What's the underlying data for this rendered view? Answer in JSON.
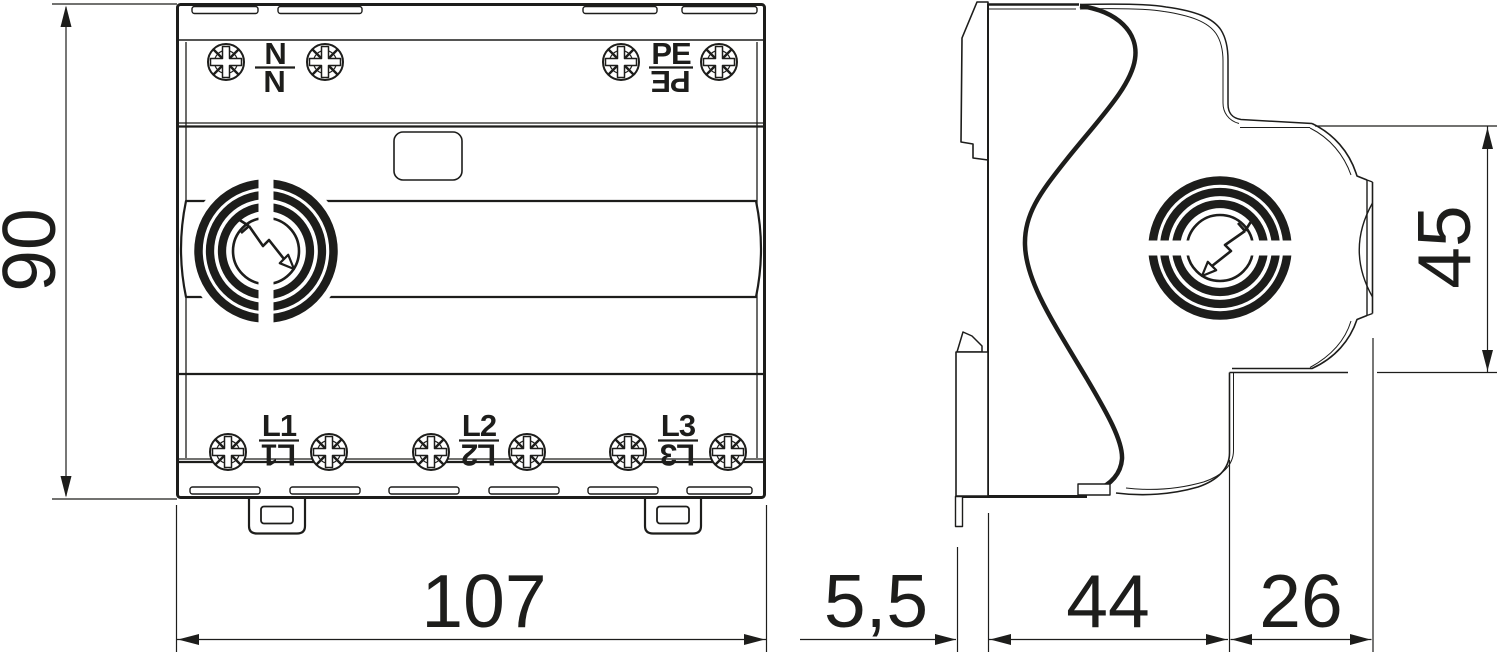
{
  "colors": {
    "background": "#ffffff",
    "line": "#1d1d1b"
  },
  "front_view": {
    "top_terminals": [
      {
        "top": "N",
        "bottom": "N"
      },
      {
        "top": "PE",
        "bottom": "PE"
      }
    ],
    "bottom_terminals": [
      {
        "top": "L1",
        "bottom": "L1"
      },
      {
        "top": "L2",
        "bottom": "L2"
      },
      {
        "top": "L3",
        "bottom": "L3"
      }
    ]
  },
  "dimensions": {
    "overall_height": "90",
    "overall_width": "107",
    "rail_clip_depth": "5,5",
    "base_depth": "44",
    "front_depth": "26",
    "front_height": "45"
  },
  "icons": {
    "screw": "combi-screw-head-icon",
    "logo": "surge-arrow-logo-icon"
  }
}
